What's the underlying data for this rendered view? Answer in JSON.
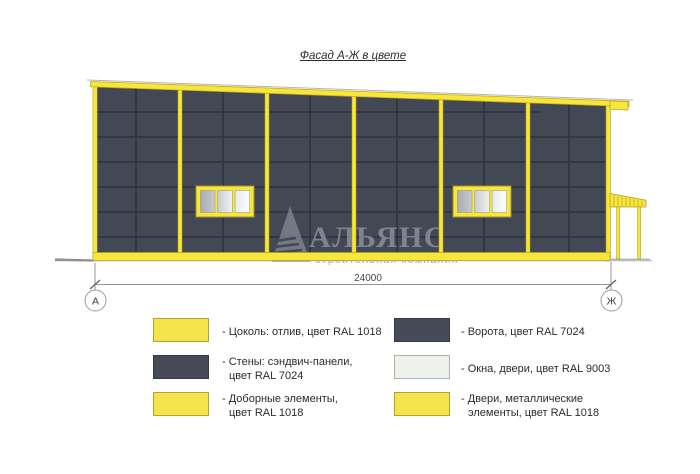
{
  "title": "Фасад А-Ж в цвете",
  "drawing": {
    "dimension_label": "24000",
    "axis_left_label": "А",
    "axis_right_label": "Ж",
    "watermark_name": "АЛЬЯНС",
    "watermark_tagline": "строительная компания"
  },
  "colors": {
    "wall_ral7024": "#424854",
    "panel_joint": "#2F333C",
    "accent_ral1018": "#F8E73B",
    "accent_border": "#B89E22",
    "glass_ral9003": "#EDF2EC",
    "drafting_line": "#8F969B"
  },
  "legend": {
    "left": [
      {
        "color": "#F5E34B",
        "border": "#B3A137",
        "lines": [
          "- Цоколь: отлив, цвет RAL 1018",
          ""
        ]
      },
      {
        "color": "#464B57",
        "border": "#343947",
        "lines": [
          "- Стены: сэндвич-панели,",
          "цвет RAL 7024"
        ]
      },
      {
        "color": "#F5E34B",
        "border": "#B3A137",
        "lines": [
          "- Доборные элементы,",
          "цвет RAL 1018"
        ]
      }
    ],
    "right": [
      {
        "color": "#464B57",
        "border": "#343947",
        "lines": [
          "- Ворота, цвет RAL 7024",
          ""
        ]
      },
      {
        "color": "#EDF2EB",
        "border": "#A9B3A6",
        "lines": [
          "- Окна, двери, цвет RAL 9003",
          ""
        ]
      },
      {
        "color": "#F5E34B",
        "border": "#B3A137",
        "lines": [
          "- Двери, металлические",
          "элементы, цвет RAL 1018"
        ]
      }
    ]
  }
}
